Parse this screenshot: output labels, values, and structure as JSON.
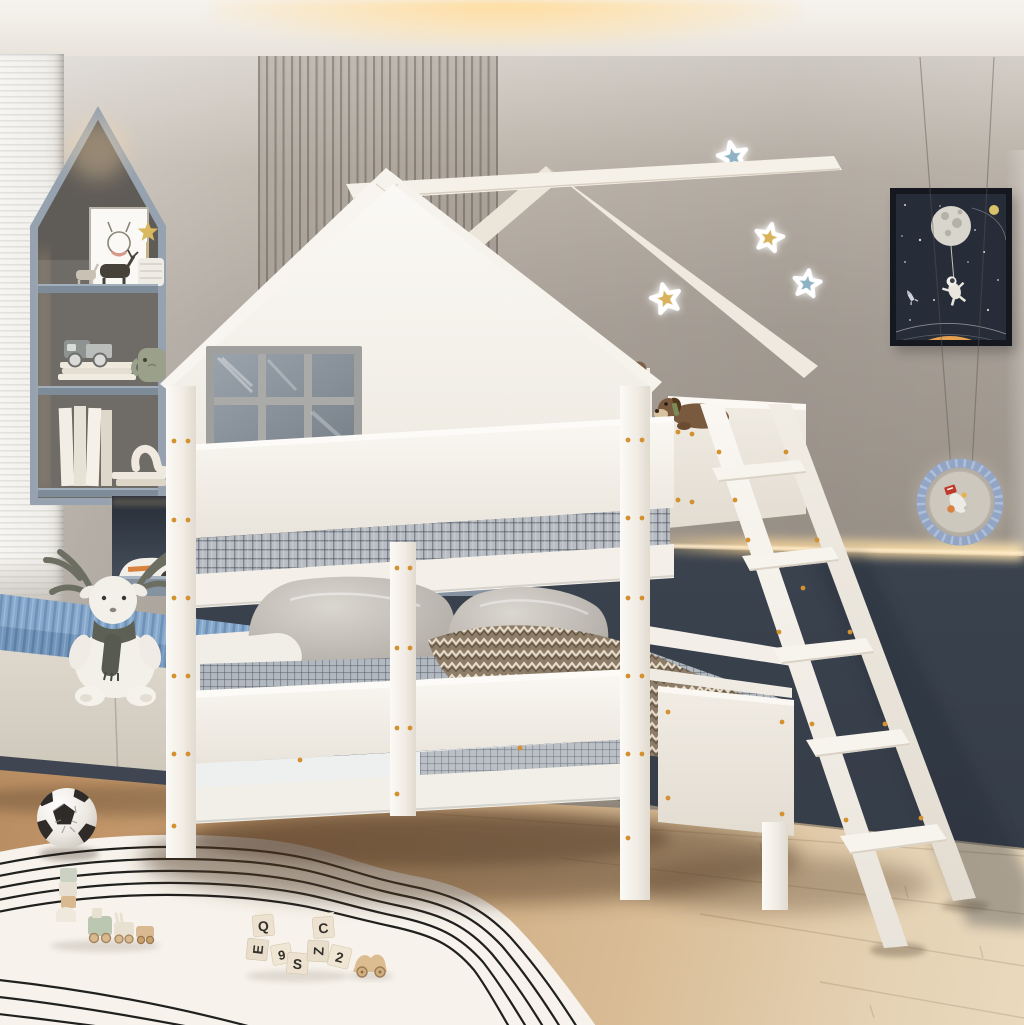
{
  "scene": {
    "title": "Kids bedroom with white house-frame bunk bed, ladder, shelf niche, window bench and toys",
    "blocks": {
      "letters": [
        "Q",
        "E",
        "9",
        "S",
        "C",
        "Z",
        "2"
      ]
    }
  },
  "colors": {
    "ceiling": "#f1ede7",
    "cove_glow": "#ffdfa8",
    "wall": "#a79f96",
    "wall_light": "#d7d2cb",
    "slat_dark": "#6e675e",
    "wainscot_navy": "#3b434f",
    "led_glow": "#ffd9a0",
    "floor_warm": "#c7a176",
    "floor_pale": "#e4d3b8",
    "rug_cream": "#f7f3ec",
    "rug_line": "#20201e",
    "bed_white": "#f6f2ec",
    "window_gray": "#a0a19f",
    "pane_blue": "#86909a",
    "cushion_blue": "#7e9fc3",
    "shelf_frame": "#96a2af",
    "star_blue": "#8fb3c4",
    "star_yellow": "#d9b25c",
    "poster_navy": "#272c39",
    "poster_planet": "#e5a14f",
    "screw_orange": "#d3922f",
    "teddy_brown": "#8a6b4f",
    "blanket_taupe": "#b3a18c",
    "plaid_gray": "#b4bac1",
    "toy_wood": "#dcbd92"
  }
}
